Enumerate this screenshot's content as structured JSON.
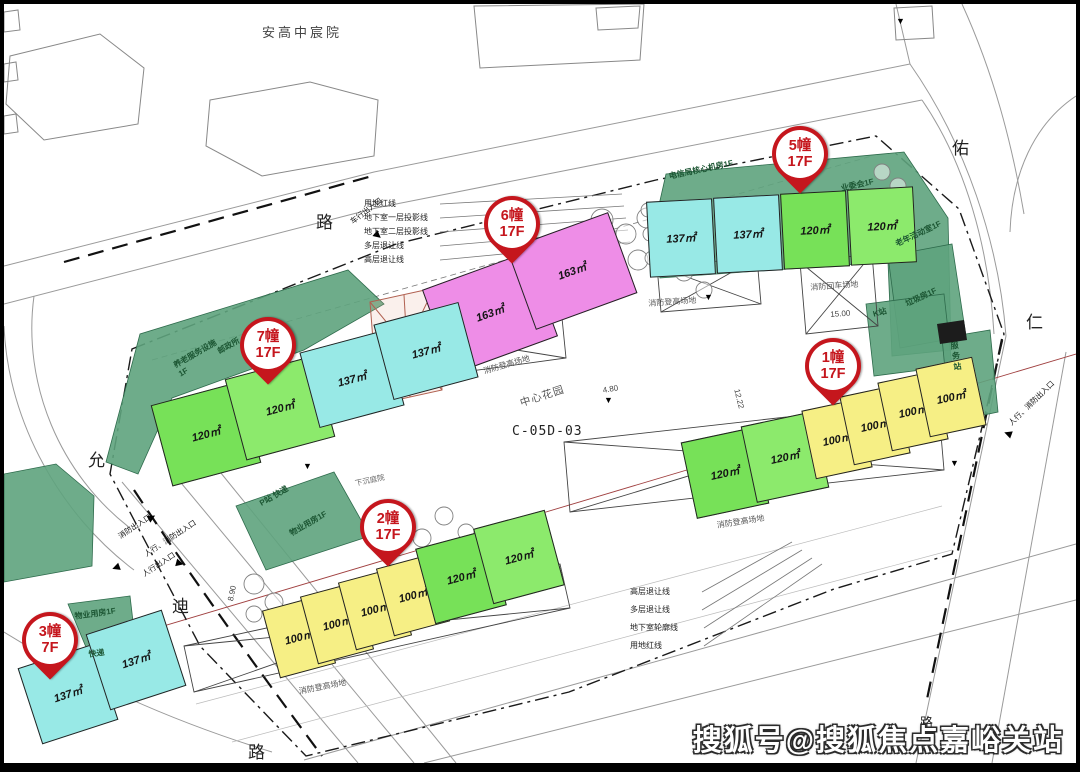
{
  "project": {
    "name": "安高中宸院",
    "center_garden": "中心花园",
    "parcel_code": "C-05D-03"
  },
  "roads": {
    "top": "路",
    "right_top": "佑",
    "right": "仁",
    "left": "允",
    "bottom_left": "迪",
    "bottom": "路",
    "watermark_road": "路"
  },
  "boundary_notes_top": [
    "用地红线",
    "地下室一层投影线",
    "地下室二层投影线",
    "多层退让线",
    "高层退让线"
  ],
  "legend_notes": [
    "高层退让线",
    "多层退让线",
    "地下室轮廓线",
    "用地红线"
  ],
  "entrances": {
    "vehicle": "车行出入口",
    "pedestrian": "人行出入口",
    "fire": "消防出入口",
    "ped_fire": "人行、消防出入口"
  },
  "site_marks": {
    "fire_climb": "消防登高场地",
    "fire_turn": "消防回车场地",
    "sunken_yard": "下沉庭院",
    "dim_15": "15.00",
    "dim_8_9": "8.90",
    "dim_4_8": "4.80",
    "dim_12_22": "12.22"
  },
  "facilities": {
    "telecom": "电信局核心机房1F",
    "committee": "业委会1F",
    "elder_room": "老年活动室1F",
    "trash_room": "垃圾房1F",
    "k_station": "K站",
    "service_station": "服务站",
    "elder_care": "养老服务设施1F",
    "post_office": "邮政所",
    "p_station": "P站 快递",
    "property_2": "物业用房1F",
    "property_3": "物业用房1F",
    "express_3": "快递"
  },
  "buildings": [
    {
      "id": "1幢",
      "floors": "17F",
      "units": [
        {
          "size": "120㎡"
        },
        {
          "size": "120㎡"
        },
        {
          "size": "100㎡"
        },
        {
          "size": "100㎡"
        },
        {
          "size": "100㎡"
        },
        {
          "size": "100㎡"
        }
      ]
    },
    {
      "id": "2幢",
      "floors": "17F",
      "units": [
        {
          "size": "100㎡"
        },
        {
          "size": "100㎡"
        },
        {
          "size": "100㎡"
        },
        {
          "size": "100㎡"
        },
        {
          "size": "120㎡"
        },
        {
          "size": "120㎡"
        }
      ]
    },
    {
      "id": "3幢",
      "floors": "7F",
      "units": [
        {
          "size": "137㎡"
        },
        {
          "size": "137㎡"
        }
      ]
    },
    {
      "id": "5幢",
      "floors": "17F",
      "units": [
        {
          "size": "137㎡"
        },
        {
          "size": "137㎡"
        },
        {
          "size": "120㎡"
        },
        {
          "size": "120㎡"
        }
      ]
    },
    {
      "id": "6幢",
      "floors": "17F",
      "units": [
        {
          "size": "163㎡"
        },
        {
          "size": "163㎡"
        }
      ]
    },
    {
      "id": "7幢",
      "floors": "17F",
      "units": [
        {
          "size": "120㎡"
        },
        {
          "size": "120㎡"
        },
        {
          "size": "137㎡"
        },
        {
          "size": "137㎡"
        }
      ]
    }
  ],
  "watermark": "搜狐号@搜狐焦点嘉峪关站",
  "colors": {
    "badge_red": "#c5161d",
    "unit_cyan": "#98e9e6",
    "unit_green": "#77e158",
    "unit_yellow": "#f6ef85",
    "unit_pink": "#ee8de7",
    "podium_green": "#5ea37d"
  }
}
